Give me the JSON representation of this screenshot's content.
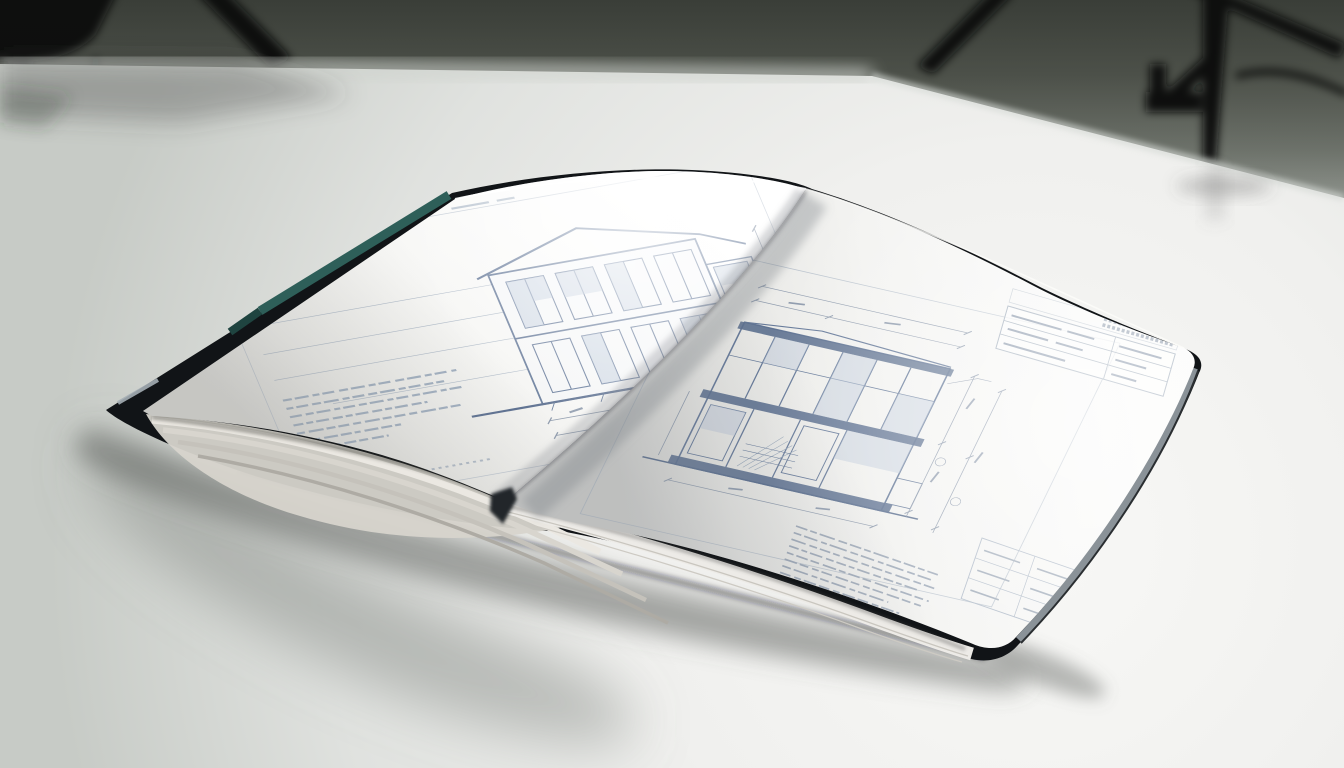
{
  "scene": {
    "subject": "open-architecture-book-photograph",
    "aria": "Photograph of an open hardcover book of architectural blueprint drawings lying on a bright studio table, with blurred tripod light stands in the dark background",
    "objects": {
      "backdrop": "studio-backdrop",
      "tripod_left": "tripod-stand-left",
      "tripod_right": "tripod-stand-right",
      "table": "studio-table",
      "book": "open-blueprint-book",
      "left_page": "left-page-elevation-drawing",
      "right_page": "right-page-section-drawing",
      "cover": "dark-hardcover",
      "accent": "teal-cover-edge",
      "stack": "page-stack-edges",
      "shadow": "book-cast-shadow"
    }
  },
  "palette": {
    "backdrop_top": "#4a4e47",
    "backdrop_mid": "#767b73",
    "backdrop_low": "#cdd1cc",
    "table_bright": "#f8f8f6",
    "table_mid": "#e0e2df",
    "table_shaded": "#c7cbc6",
    "tripod_black": "#0c0e10",
    "book_cover": "#111417",
    "cover_teal": "#2e5f59",
    "cover_teal_dark": "#1f4440",
    "cover_edge_gray": "#8a9298",
    "tip_glint": "#a5aeb5",
    "page_white": "#ffffff",
    "page_shade": "#d9d9d6",
    "stack_cream": "#d7d4cc",
    "stack_line_dark": "#aeaba4",
    "blueprint_light": "#93a3b7",
    "blueprint_medium": "#6e829d",
    "blueprint_strong": "#53688a",
    "blueprint_fill": "#b9c6d8",
    "dim_text": "#8a97aa",
    "frame_faint": "#a9b5c4"
  }
}
